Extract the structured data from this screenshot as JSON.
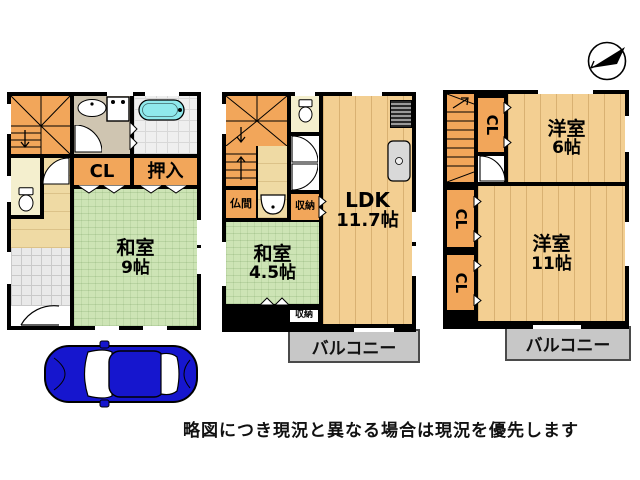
{
  "floor1": {
    "rooms": {
      "washitsu": {
        "label": "和室",
        "size": "9帖"
      },
      "cl": {
        "label": "CL"
      },
      "oshiire": {
        "label": "押入"
      }
    }
  },
  "floor2": {
    "rooms": {
      "ldk": {
        "label": "LDK",
        "size": "11.7帖"
      },
      "washitsu": {
        "label": "和室",
        "size": "4.5帖"
      },
      "butsuma": {
        "label": "仏間"
      },
      "shunou": {
        "label": "収納"
      },
      "shunou_lower": {
        "label": "収納"
      }
    },
    "balcony": {
      "label": "バルコニー"
    }
  },
  "floor3": {
    "rooms": {
      "yoshitsu6": {
        "label": "洋室",
        "size": "6帖"
      },
      "yoshitsu11": {
        "label": "洋室",
        "size": "11帖"
      },
      "cl_top": {
        "label": "CL"
      },
      "cl_mid": {
        "label": "CL"
      },
      "cl_bottom": {
        "label": "CL"
      }
    },
    "balcony": {
      "label": "バルコニー"
    }
  },
  "footer": {
    "disclaimer": "略図につき現況と異なる場合は現況を優先します"
  },
  "colors": {
    "wall": "#000000",
    "closet_orange": "#F2A65A",
    "tatami_green": "#CDE4B5",
    "wood_floor": "#F3CF92",
    "balcony_gray": "#C7C7C7",
    "bathtub_cyan": "#8FE9EC",
    "car_blue": "#1616CE"
  }
}
